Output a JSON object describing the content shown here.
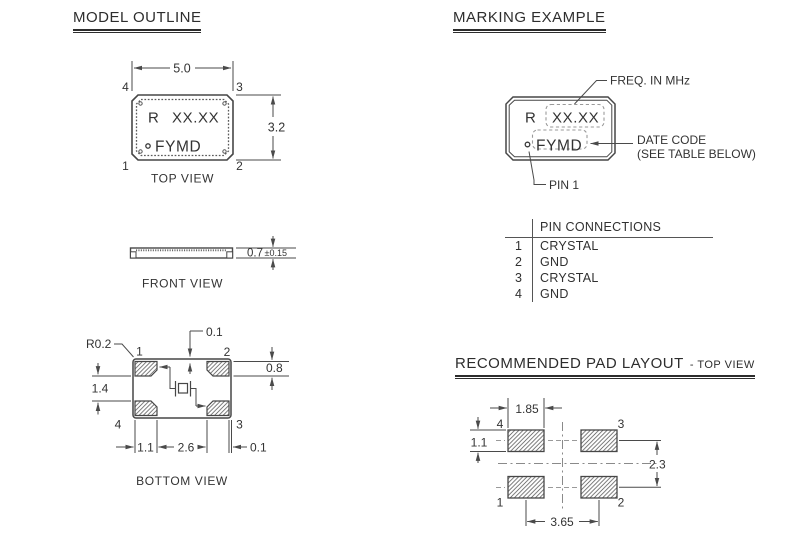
{
  "colors": {
    "ink": "#333333",
    "line": "#4a4a4a",
    "muted": "#9a9a9a",
    "background": "#ffffff"
  },
  "sections": {
    "model_outline": {
      "title": "MODEL OUTLINE",
      "top_view": {
        "label": "TOP VIEW",
        "marking_prefix": "R",
        "marking_freq": "XX.XX",
        "marking_date": "FYMD",
        "dim_width": "5.0",
        "dim_height": "3.2",
        "pin_top_left": "4",
        "pin_top_right": "3",
        "pin_bottom_left": "1",
        "pin_bottom_right": "2"
      },
      "front_view": {
        "label": "FRONT VIEW",
        "dim_thickness": "0.7",
        "dim_tolerance": "±0.15"
      },
      "bottom_view": {
        "label": "BOTTOM VIEW",
        "dim_corner_radius": "R0.2",
        "dim_pad_offset_top": "0.1",
        "dim_pad_height": "0.8",
        "dim_pad_gap_vertical": "1.4",
        "dim_pad_width": "1.1",
        "dim_pad_gap_horizontal": "2.6",
        "dim_pad_offset_right": "0.1",
        "pin_top_left": "1",
        "pin_top_right": "2",
        "pin_bottom_left": "4",
        "pin_bottom_right": "3"
      }
    },
    "marking_example": {
      "title": "MARKING EXAMPLE",
      "marking_prefix": "R",
      "marking_freq": "XX.XX",
      "marking_date": "FYMD",
      "callout_freq": "FREQ. IN MHz",
      "callout_date_line1": "DATE CODE",
      "callout_date_line2": "(SEE TABLE BELOW)",
      "callout_pin1": "PIN 1"
    },
    "pin_connections": {
      "title": "PIN CONNECTIONS",
      "rows": [
        {
          "pin": "1",
          "function": "CRYSTAL"
        },
        {
          "pin": "2",
          "function": "GND"
        },
        {
          "pin": "3",
          "function": "CRYSTAL"
        },
        {
          "pin": "4",
          "function": "GND"
        }
      ]
    },
    "pad_layout": {
      "title": "RECOMMENDED PAD LAYOUT",
      "subtitle": "- TOP VIEW",
      "label_pad_4": "4",
      "label_pad_3": "3",
      "label_pad_1": "1",
      "label_pad_2": "2",
      "dim_pad_width": "1.85",
      "dim_pad_height": "1.1",
      "dim_pitch_vertical": "2.3",
      "dim_pitch_horizontal": "3.65"
    }
  }
}
